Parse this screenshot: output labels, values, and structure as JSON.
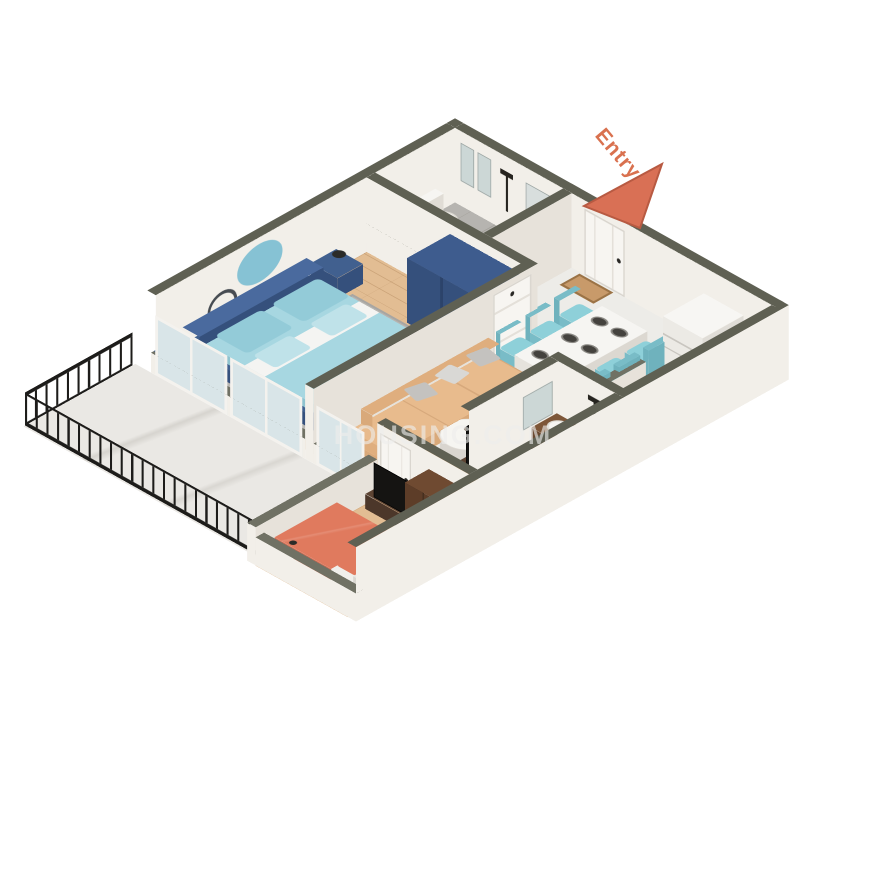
{
  "entry": {
    "label": "Entry"
  },
  "watermark": {
    "text": "HOUSING.COM"
  },
  "palette": {
    "wallTop": "#5f6053",
    "wallTopLight": "#707164",
    "wallFace": "#f2efe9",
    "wallFaceShade": "#e7e2da",
    "marble": "#edece8",
    "balcony": "#eae8e4",
    "tile": "#b6b4b0",
    "tileLine": "#a3a09a",
    "wood": "#e2bd93",
    "rug": "#b7b5b1",
    "navy": "#41608f",
    "navyDark": "#35507c",
    "tealBedding": "#a7d7e1",
    "tealPillow": "#93cbd8",
    "tealDecor": "#86c2d4",
    "sofa": "#e8bb8d",
    "sofaShade": "#d9a97a",
    "pillowGray": "#c4c2bf",
    "chairTeal": "#8ed0d9",
    "tableWhite": "#f6f5f2",
    "coral": "#e07a5e",
    "coralDark": "#cf6a50",
    "brown": "#6f4a31",
    "brownMid": "#7d5638",
    "sinkBrown": "#8a5f3e",
    "fixtureBlack": "#26241f",
    "railing": "#1d1c1a",
    "entry": "#d9714f",
    "watermark": "rgba(238,238,235,0.62)"
  },
  "rooms": [
    {
      "name": "master-bedroom",
      "items": [
        "double-bed-blue",
        "teal-bedding",
        "wardrobe-navy",
        "nightstand-lamp-left",
        "nightstand-lamp-right",
        "oval-wall-decor",
        "ring-mirror",
        "tv-cabinet",
        "area-rug"
      ]
    },
    {
      "name": "bathroom-1",
      "items": [
        "toilet",
        "shower-set",
        "wash-basin",
        "wall-mirror",
        "window-panels",
        "door"
      ]
    },
    {
      "name": "living-dining",
      "items": [
        "l-shaped-sofa",
        "gray-cushions",
        "coffee-table",
        "side-table",
        "dining-table",
        "dining-chairs-x6",
        "plates",
        "doormat",
        "tv-panel",
        "balcony-glass-doors"
      ]
    },
    {
      "name": "kitchen",
      "items": [
        "refrigerator",
        "gas-stove",
        "kitchen-sink",
        "counter",
        "half-wall"
      ]
    },
    {
      "name": "bathroom-2",
      "items": [
        "vanity-basin",
        "wall-mirror",
        "shower-set",
        "toilet",
        "door"
      ]
    },
    {
      "name": "bedroom-2",
      "items": [
        "double-bed-coral",
        "tv-unit",
        "wardrobe-brown",
        "nightstand-1",
        "nightstand-2",
        "area-rug",
        "door"
      ]
    },
    {
      "name": "balcony",
      "items": [
        "iron-railing",
        "marble-floor"
      ]
    },
    {
      "name": "entry",
      "items": [
        "entry-door",
        "doormat",
        "entry-arrow"
      ]
    }
  ]
}
